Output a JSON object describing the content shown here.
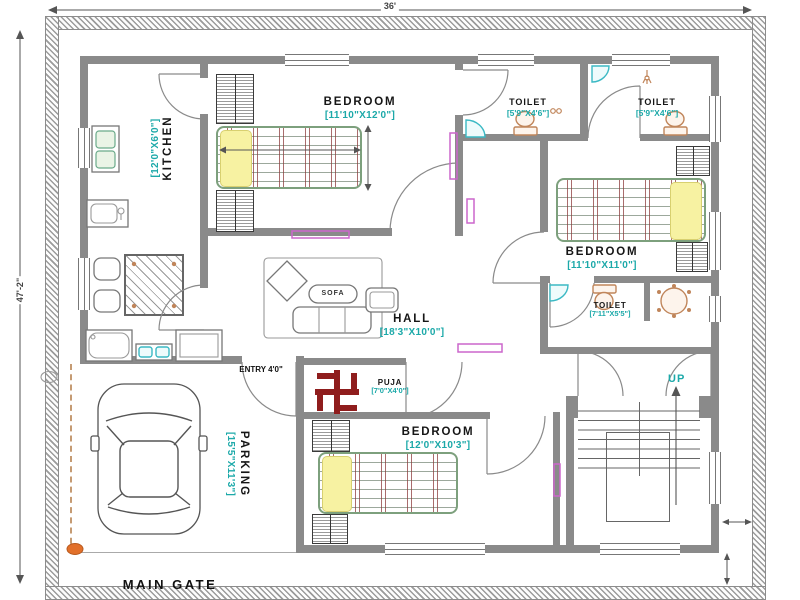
{
  "dimensions": {
    "top": "36'",
    "left": "47'-2\""
  },
  "rooms": {
    "bedroom1": {
      "name": "BEDROOM",
      "dims": "[11'10\"X12'0\"]"
    },
    "toilet1": {
      "name": "TOILET",
      "dims": "[5'9\"X4'6\"]"
    },
    "toilet2": {
      "name": "TOILET",
      "dims": "[5'9\"X4'6\"]"
    },
    "bedroom2": {
      "name": "BEDROOM",
      "dims": "[11'10\"X11'0\"]"
    },
    "toilet3": {
      "name": "TOILET",
      "dims": "[7'11\"X5'5\"]"
    },
    "hall": {
      "name": "HALL",
      "dims": "[18'3\"X10'0\"]"
    },
    "puja": {
      "name": "PUJA",
      "dims": "[7'0\"X4'0\"]"
    },
    "bedroom3": {
      "name": "BEDROOM",
      "dims": "[12'0\"X10'3\"]"
    },
    "kitchen": {
      "name": "KITCHEN",
      "dims": "[12'0\"X6'0\"]"
    },
    "parking": {
      "name": "PARKING",
      "dims": "[15'5\"X11'3\"]"
    }
  },
  "labels": {
    "entry": "ENTRY 4'0\"",
    "main_gate": "MAIN GATE",
    "up": "UP",
    "sofa": "SOFA"
  },
  "icons": {
    "swastika": "swastika-icon",
    "car": "car-icon",
    "stairs": "stairs-up-icon"
  },
  "colors": {
    "dim_text": "#1ca9a9",
    "wall": "#8a8a8a",
    "swastika": "#8f1d1d",
    "bed_yellow": "#f7f2a2",
    "fixture_tan": "#c0855a",
    "fixture_teal": "#3bb9c4",
    "accent_magenta": "#cc66cc",
    "gate_dot": "#e2702a"
  }
}
